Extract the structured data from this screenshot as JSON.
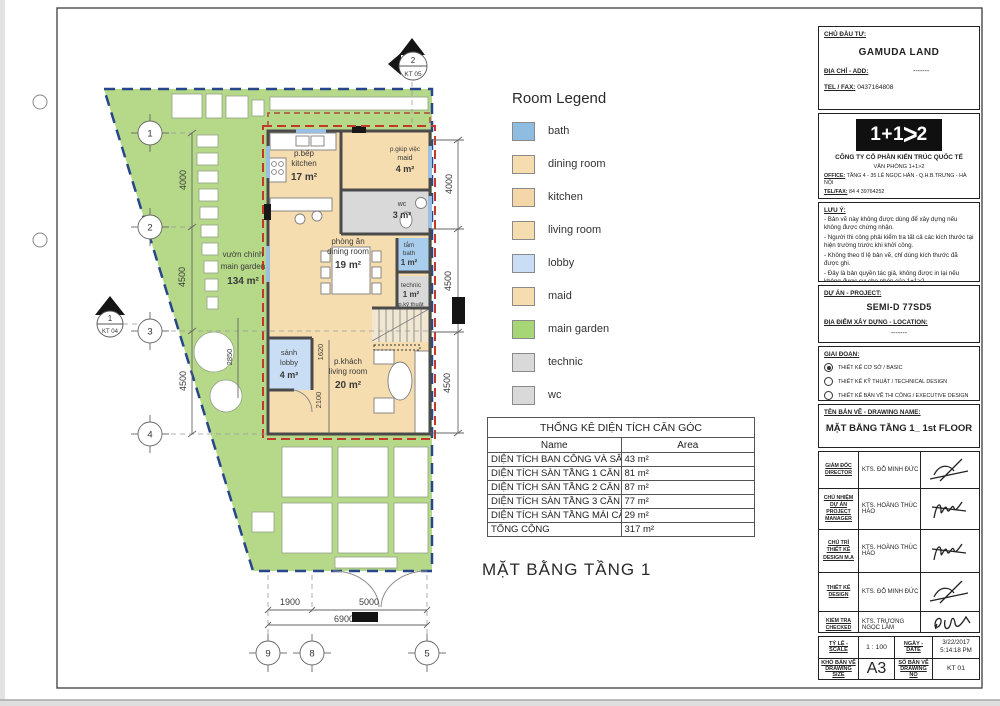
{
  "sheet": {
    "main_title": "MẶT BẰNG TẦNG 1"
  },
  "legend": {
    "title": "Room Legend",
    "items": [
      {
        "label": "bath",
        "color": "#8fbde2"
      },
      {
        "label": "dining room",
        "color": "#f6ddb0"
      },
      {
        "label": "kitchen",
        "color": "#f3d7a8"
      },
      {
        "label": "living room",
        "color": "#f6ddb0"
      },
      {
        "label": "lobby",
        "color": "#c9def4"
      },
      {
        "label": "maid",
        "color": "#f6ddb0"
      },
      {
        "label": "main garden",
        "color": "#a7d677"
      },
      {
        "label": "technic",
        "color": "#d9d9d9"
      },
      {
        "label": "wc",
        "color": "#d9d9d9"
      }
    ]
  },
  "table": {
    "title": "THỐNG KÊ DIỆN TÍCH CĂN GÓC",
    "col_name": "Name",
    "col_area": "Area",
    "rows": [
      {
        "name": "DIỆN TÍCH BAN CÔNG VÀ SÂN MÁI CĂN GÓC",
        "area": "43 m²"
      },
      {
        "name": "DIỆN TÍCH SÀN TẦNG 1 CĂN GÓC",
        "area": "81 m²"
      },
      {
        "name": "DIỆN TÍCH SÀN TẦNG 2 CĂN GÓC",
        "area": "87 m²"
      },
      {
        "name": "DIỆN TÍCH SÀN TẦNG 3 CĂN GÓC",
        "area": "77 m²"
      },
      {
        "name": "DIỆN TÍCH SÀN TẦNG MÁI CĂN GÓC",
        "area": "29 m²"
      },
      {
        "name": "TỔNG CỘNG",
        "area": "317 m²"
      }
    ]
  },
  "plan": {
    "rooms": {
      "kitchen": {
        "l1": "p.bếp",
        "l2": "kitchen",
        "area": "17 m²"
      },
      "maid": {
        "l1": "p.giúp việc",
        "l2": "maid",
        "area": "4 m²"
      },
      "wc": {
        "l1": "wc",
        "area": "3 m²"
      },
      "dining": {
        "l1": "phòng ăn",
        "l2": "dining room",
        "area": "19 m²"
      },
      "bath": {
        "l1": "tắm",
        "l2": "bath",
        "area": "1 m²"
      },
      "technic": {
        "l1": "technic",
        "l2": "p.kỹ thuật",
        "area": "1 m²"
      },
      "lobby": {
        "l1": "sảnh",
        "l2": "lobby",
        "area": "4 m²"
      },
      "living": {
        "l1": "p.khách",
        "l2": "living room",
        "area": "20 m²"
      },
      "garden": {
        "l1": "vườn chính",
        "l2": "main garden",
        "area": "134 m²"
      }
    },
    "dims": {
      "left": [
        "4000",
        "4500",
        "4500"
      ],
      "right": [
        "4000",
        "4500",
        "4500"
      ],
      "bottom": [
        "1900",
        "5000",
        "6900"
      ],
      "v1": "1620",
      "v2": "2100",
      "v3": "2850"
    },
    "grid": {
      "g1": "1",
      "g2": "2",
      "g3": "3",
      "g4": "4",
      "g9": "9",
      "g8": "8",
      "g5": "5"
    },
    "markers": {
      "top_num": "2",
      "top_ref": "KT 05",
      "left_num": "1",
      "left_ref": "KT 04"
    }
  },
  "titleblock": {
    "owner_label": "CHỦ ĐẦU TƯ:",
    "owner": "GAMUDA LAND",
    "addr_label": "ĐỊA CHỈ - ADD:",
    "addr": "-------",
    "tel_label": "TEL / FAX:",
    "tel": "0437164808",
    "logo": {
      "p1": "1+1",
      "chev": ">",
      "p2": "2"
    },
    "company": "CÔNG TY CỔ PHẦN KIẾN TRÚC QUỐC TẾ",
    "office_name": "VĂN PHÒNG 1+1>2",
    "office_label": "OFFICE:",
    "office": "TẦNG 4 - 35 LÊ NGỌC HÂN - Q.H.B.TRƯNG - HÀ NỘI",
    "telfax_label": "TEL/FAX:",
    "telfax": "84 4 39764252",
    "email_label": "EMAIL:",
    "email": "INFO@KIENTRUC112.COM.VN",
    "notes_label": "LƯU Ý:",
    "notes": [
      "- Bản vẽ này không được dùng để xây dựng nếu không được chứng nhận.",
      "- Người thi công phải kiểm tra tất cả các kích thước tại hiện trường trước khi khởi công.",
      "- Không theo tỉ lệ bản vẽ, chỉ dùng kích thước đã được ghi.",
      "- Đây là bản quyền tác giả, không được in lại nếu không được sự cho phép của 1+1>2."
    ],
    "project_label": "DỰ ÁN - PROJECT:",
    "project": "SEMI-D 77SD5",
    "location_label": "ĐỊA ĐIỂM XÂY DỰNG - LOCATION:",
    "location": "-------",
    "phase_label": "GIAI ĐOẠN:",
    "phases": [
      {
        "label": "THIẾT KẾ CƠ SỞ / BASIC",
        "selected": true
      },
      {
        "label": "THIẾT KẾ KỸ THUẬT / TECHNICAL DESIGN",
        "selected": false
      },
      {
        "label": "THIẾT KẾ BẢN VẼ THI CÔNG / EXECUTIVE DESIGN",
        "selected": false
      }
    ],
    "drawing_name_label": "TÊN BẢN VẼ - DRAWING NAME:",
    "drawing_name": "MẶT BẰNG TẦNG 1_ 1st FLOOR",
    "sign_rows": [
      {
        "role_vi": "GIÁM ĐỐC",
        "role_en": "DIRECTOR",
        "name": "KTS. ĐỖ MINH ĐỨC"
      },
      {
        "role_vi": "CHỦ NHIỆM DỰ ÁN",
        "role_en": "PROJECT MANAGER",
        "name": "KTS. HOÀNG THÚC HÀO"
      },
      {
        "role_vi": "CHỦ TRÌ THIẾT KẾ",
        "role_en": "DESIGN M.A",
        "name": "KTS. HOÀNG THÚC HÀO"
      },
      {
        "role_vi": "THIẾT KẾ",
        "role_en": "DESIGN",
        "name": "KTS. ĐỖ MINH ĐỨC"
      },
      {
        "role_vi": "KIỂM TRA",
        "role_en": "CHECKED",
        "name": "KTS. TRƯƠNG NGỌC LÂM"
      }
    ],
    "scale_label": "TỶ LỆ - SCALE",
    "scale": "1 : 100",
    "date_label": "NGÀY - DATE",
    "date": "3/22/2017",
    "time": "5:14:18 PM",
    "size_label1": "KHỔ BẢN VẼ",
    "size_label2": "DRAWING SIZE",
    "size": "A3",
    "no_label1": "SỐ BẢN VẼ",
    "no_label2": "DRAWING NO",
    "no": "KT 01"
  }
}
